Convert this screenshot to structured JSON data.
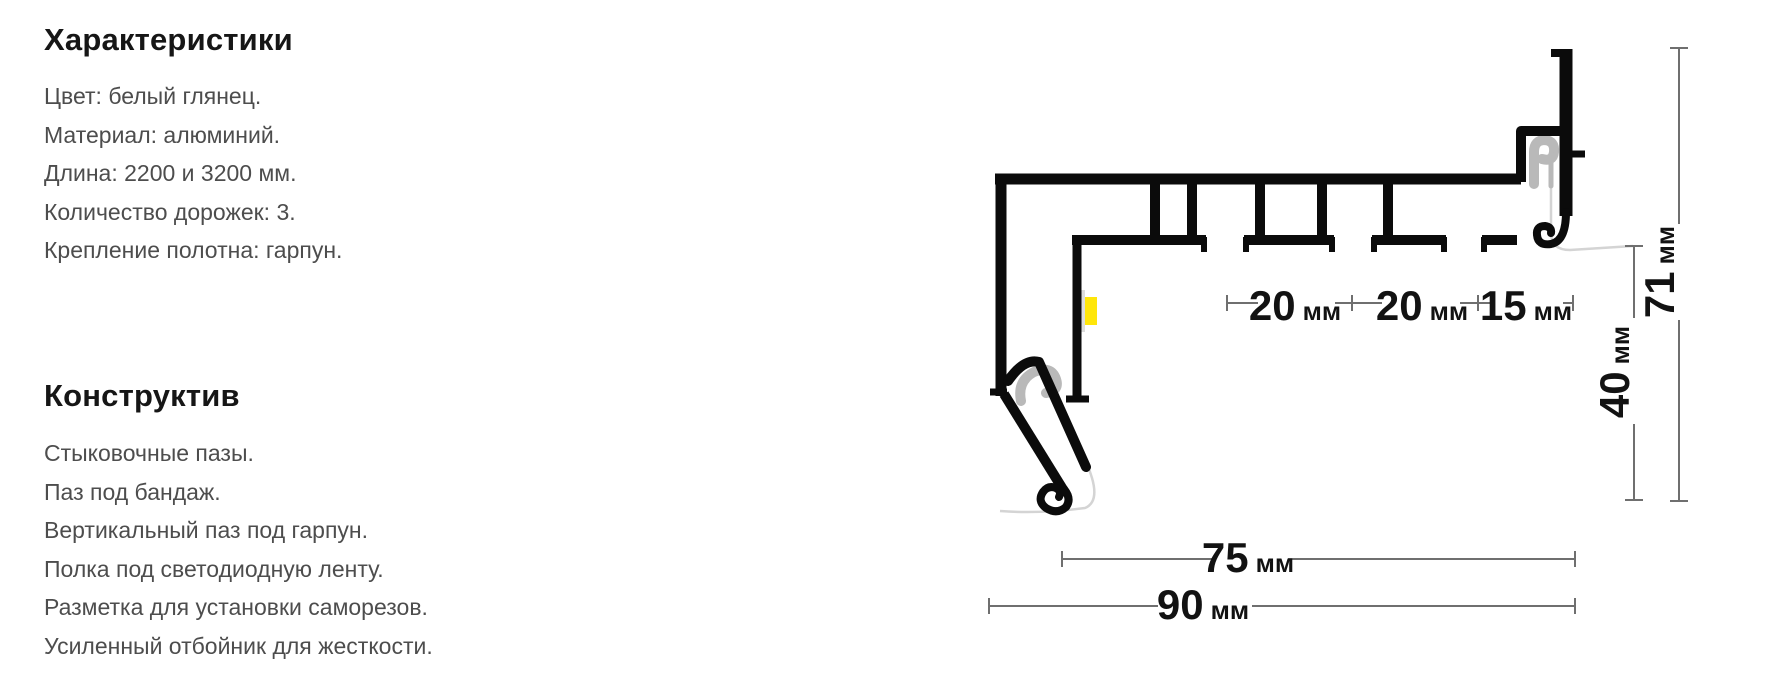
{
  "characteristics": {
    "title": "Характеристики",
    "items": [
      "Цвет: белый глянец.",
      "Материал: алюминий.",
      "Длина: 2200 и 3200 мм.",
      "Количество дорожек: 3.",
      "Крепление полотна: гарпун."
    ]
  },
  "construction": {
    "title": "Конструктив",
    "items": [
      "Стыковочные пазы.",
      "Паз под бандаж.",
      "Вертикальный паз под гарпун.",
      "Полка под светодиодную ленту.",
      "Разметка для установки саморезов.",
      "Усиленный отбойник для жесткости."
    ]
  },
  "diagram": {
    "dimensions": {
      "track_spacing_1": {
        "value": "20",
        "unit": "мм"
      },
      "track_spacing_2": {
        "value": "20",
        "unit": "мм"
      },
      "track_spacing_3": {
        "value": "15",
        "unit": "мм"
      },
      "profile_height": {
        "value": "71",
        "unit": "мм"
      },
      "visible_height": {
        "value": "40",
        "unit": "мм"
      },
      "inner_width": {
        "value": "75",
        "unit": "мм"
      },
      "total_width": {
        "value": "90",
        "unit": "мм"
      }
    },
    "colors": {
      "profile": "#0b0b0b",
      "harpoon": "#b9b9b9",
      "fabric_line": "#d4d4d4",
      "led_strip": "#ffe60a",
      "led_backing": "#dcdcdc",
      "dimension_line": "#6f6f6f",
      "dimension_text": "#121212"
    }
  }
}
